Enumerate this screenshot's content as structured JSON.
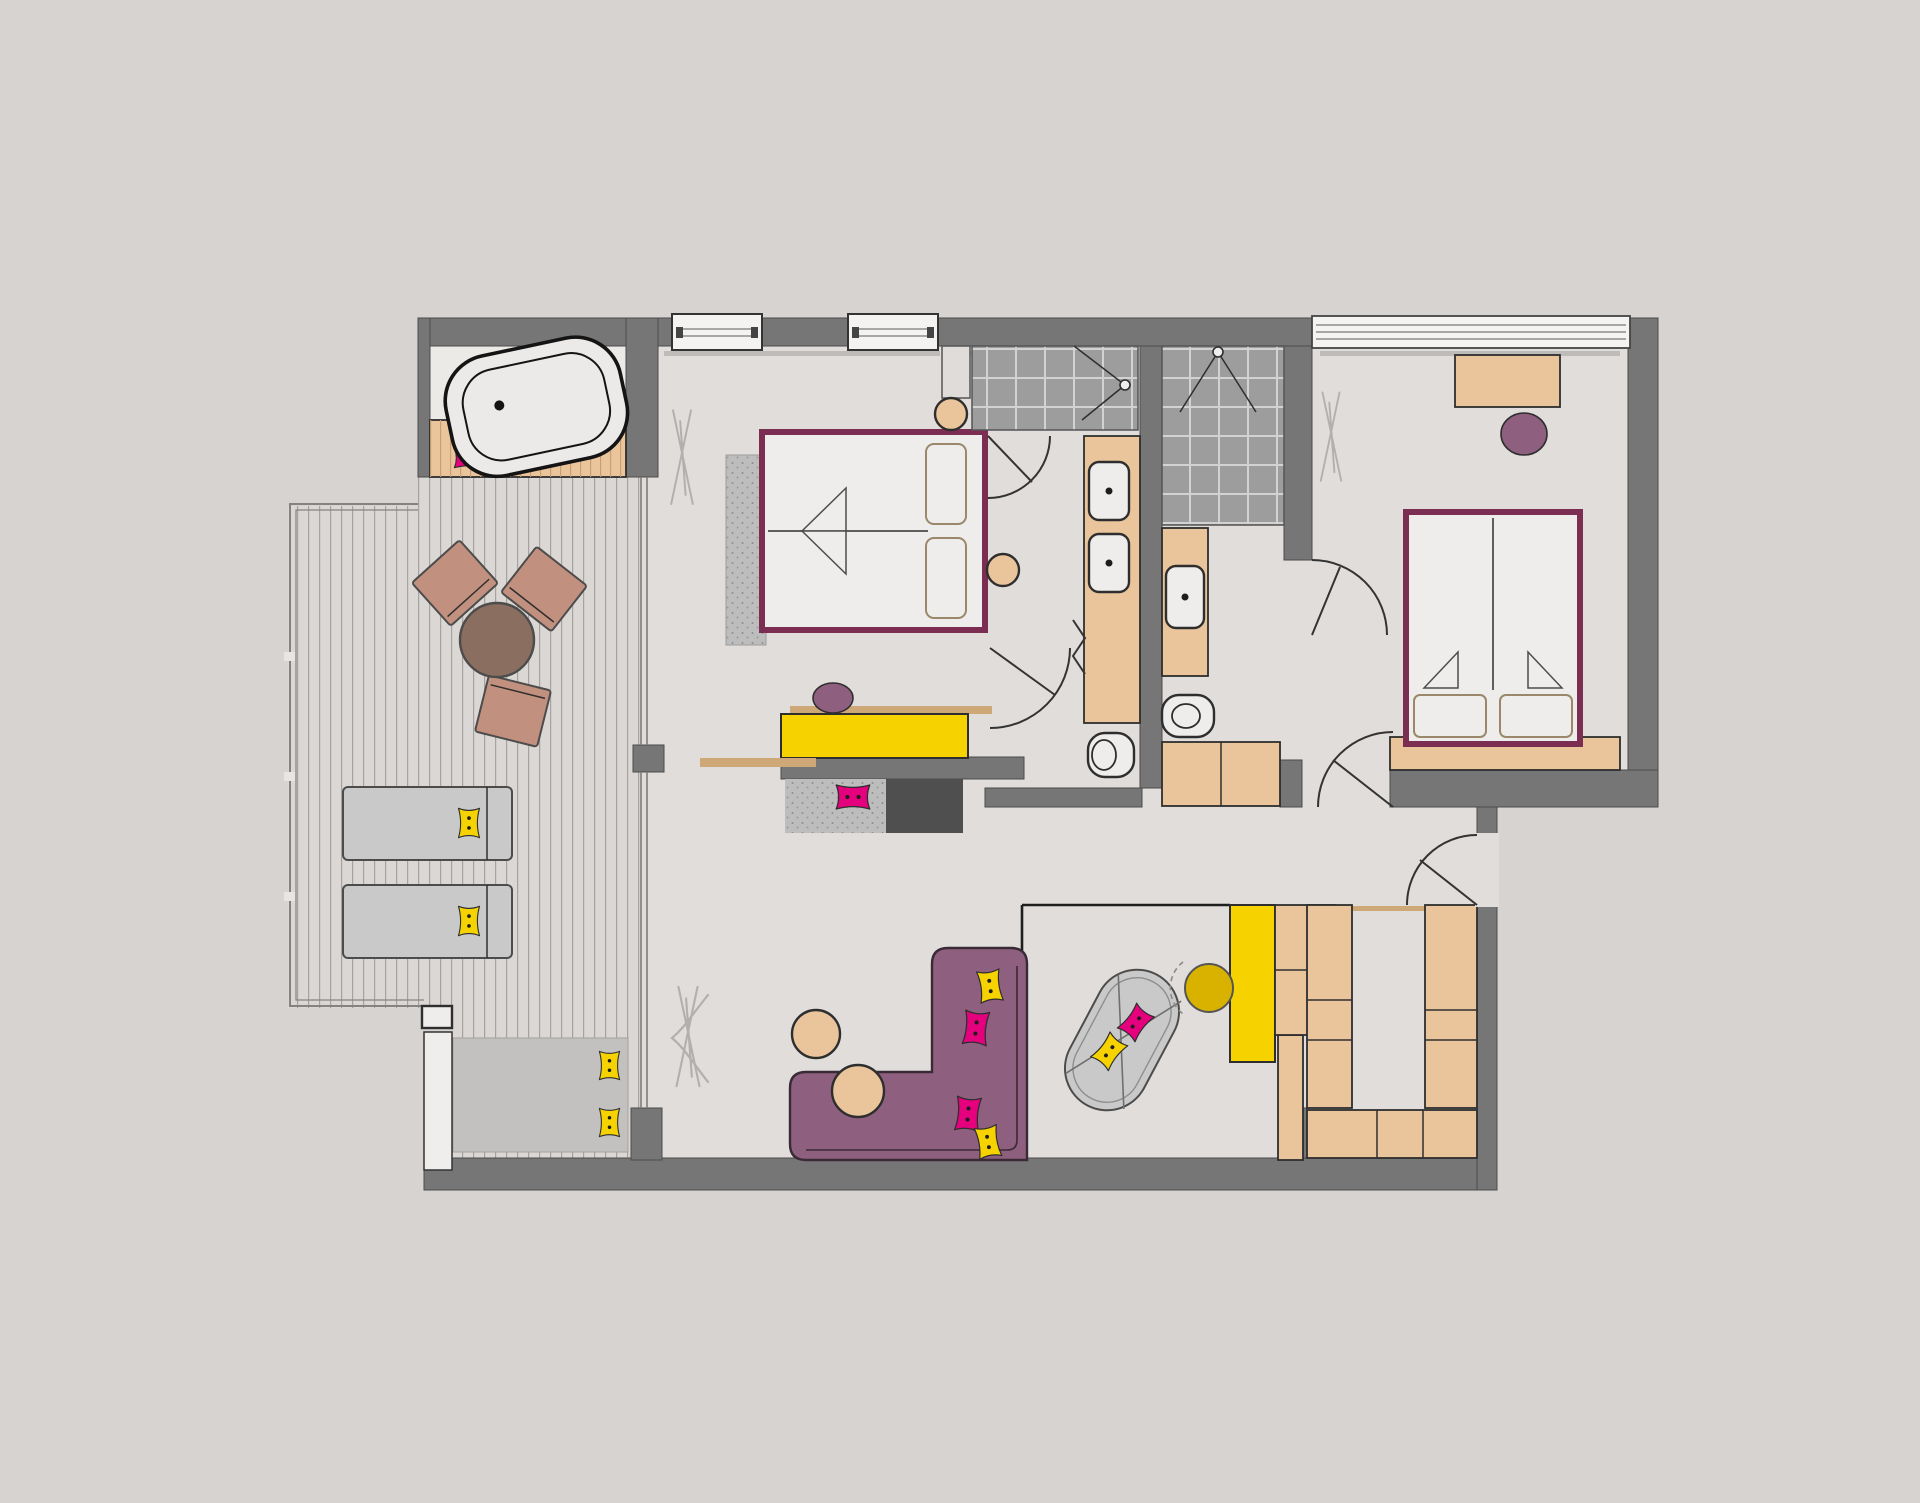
{
  "meta": {
    "title": "Hotel suite floor plan – top view (no text labels in drawing)",
    "canvas": "1920 x 1503",
    "drawing_type": "2D architectural furniture plan"
  },
  "palette": {
    "bg": "#d6d3d0",
    "wall": "#767676",
    "wallStroke": "#4c4c4c",
    "floor": "#e0ddda",
    "nicheFloor": "#eceae7",
    "deck": "#dbd7d4",
    "plank": "#a6a29f",
    "tile": "#9d9d9d",
    "tileLine": "#d2d2d2",
    "tan": "#eac59c",
    "tanDark": "#cfa878",
    "wood": "#8a6e5f",
    "terracotta": "#c2907e",
    "plum": "#7b2d52",
    "sofa": "#8e5f7e",
    "sofaEdge": "#3a2a36",
    "magenta": "#e5017d",
    "yellow": "#f6d300",
    "yellowDeep": "#d9b200",
    "gray": "#c9c9c9",
    "mat": "#c2c1bf",
    "rug": "#bdbdbd",
    "charcoal": "#4f4f4f",
    "purpleStool": "#8f5f80",
    "line": "#2e2e2e",
    "doorLine": "#333333",
    "curtain": "#b3afac",
    "white": "#efedeb"
  },
  "rooms": [
    {
      "id": "terrace",
      "label": "Terrace / balcony",
      "items": [
        "freestanding bathtub",
        "wood bench with 2 pink cushions",
        "plank decking",
        "railing",
        "round bistro table",
        "3 terrace chairs",
        "2 sun loungers with yellow cushions",
        "outdoor daybed mat with 2 yellow cushions",
        "planter",
        "step"
      ]
    },
    {
      "id": "master-bedroom",
      "label": "Master bedroom",
      "items": [
        "double bed with 2 pillows",
        "bedside rug",
        "2 round side stools",
        "2 windows",
        "curtain",
        "small wall cabinet"
      ]
    },
    {
      "id": "room-divider",
      "label": "Bedroom–living divider",
      "items": [
        "wood shelf",
        "yellow bench",
        "round purple stool",
        "gray rug with pink cushion",
        "charcoal media unit",
        "wood board"
      ]
    },
    {
      "id": "master-bathroom",
      "label": "Master bathroom",
      "items": [
        "tiled walk-in shower",
        "double washbasin vanity",
        "WC",
        "folding door",
        "swing door"
      ]
    },
    {
      "id": "second-bathroom",
      "label": "Second bathroom",
      "items": [
        "tiled walk-in shower",
        "washbasin vanity",
        "WC",
        "hall wardrobe"
      ]
    },
    {
      "id": "second-bedroom",
      "label": "Second bedroom",
      "items": [
        "double/twin bed with 2 pillows",
        "desk console",
        "purple stool",
        "glazed window front",
        "curtain"
      ]
    },
    {
      "id": "living-room",
      "label": "Living room",
      "items": [
        "L-shaped purple sofa with 4 cushions",
        "2 round poufs",
        "swivel lounge chair with 2 cushions",
        "glazed study nook",
        "yellow desk",
        "yellow swivel chair",
        "side cabinet"
      ]
    },
    {
      "id": "entry",
      "label": "Entrance hall",
      "items": [
        "entrance door",
        "2 wardrobe columns",
        "lower closet row",
        "hanging rail"
      ]
    }
  ]
}
